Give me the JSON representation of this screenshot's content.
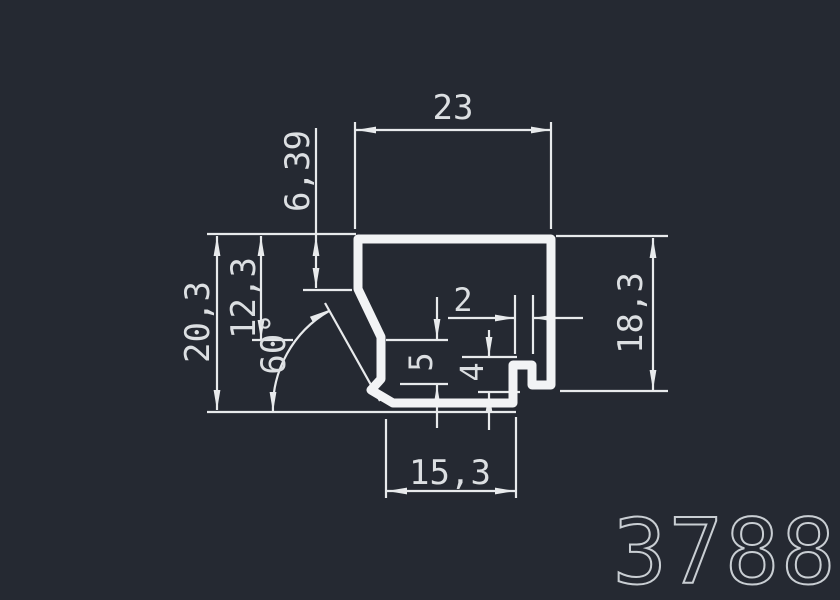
{
  "canvas": {
    "background": "#252932",
    "line_color": "#e8eaec",
    "profile_color": "#f2f3f5",
    "text_color": "#dcdfe2"
  },
  "part_number": "3788",
  "dimensions": {
    "top_width": "23",
    "top_left_offset": "6,39",
    "left_upper": "12,3",
    "left_total": "20,3",
    "angle": "60°",
    "wall_slot": "2",
    "left_step": "5",
    "hook_depth": "4",
    "right_height": "18,3",
    "bottom_width": "15,3"
  }
}
